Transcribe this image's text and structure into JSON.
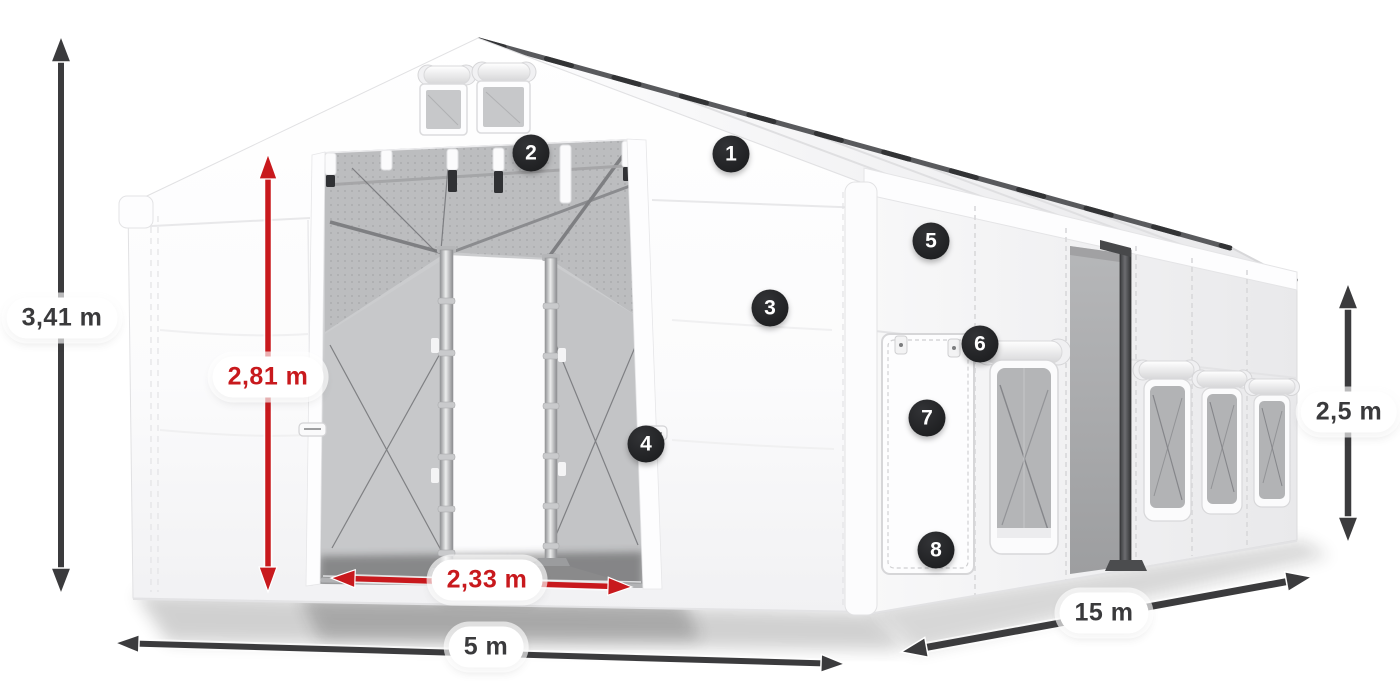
{
  "colors": {
    "page_bg": "#ffffff",
    "accent_red": "#c8191d",
    "arrow_dark": "#3b3b3d",
    "badge_bg": "#1f2022",
    "badge_text": "#ffffff",
    "label_bg": "#ffffff",
    "label_text": "#3a3a3c"
  },
  "dimensions": {
    "total_height": {
      "value": "3,41 m",
      "style": "dark"
    },
    "door_height": {
      "value": "2,81 m",
      "style": "red"
    },
    "door_width": {
      "value": "2,33 m",
      "style": "red"
    },
    "front_width": {
      "value": "5 m",
      "style": "dark"
    },
    "side_length": {
      "value": "15 m",
      "style": "dark"
    },
    "side_height": {
      "value": "2,5 m",
      "style": "dark"
    }
  },
  "markers": [
    {
      "number": "1"
    },
    {
      "number": "2"
    },
    {
      "number": "3"
    },
    {
      "number": "4"
    },
    {
      "number": "5"
    },
    {
      "number": "6"
    },
    {
      "number": "7"
    },
    {
      "number": "8"
    }
  ]
}
